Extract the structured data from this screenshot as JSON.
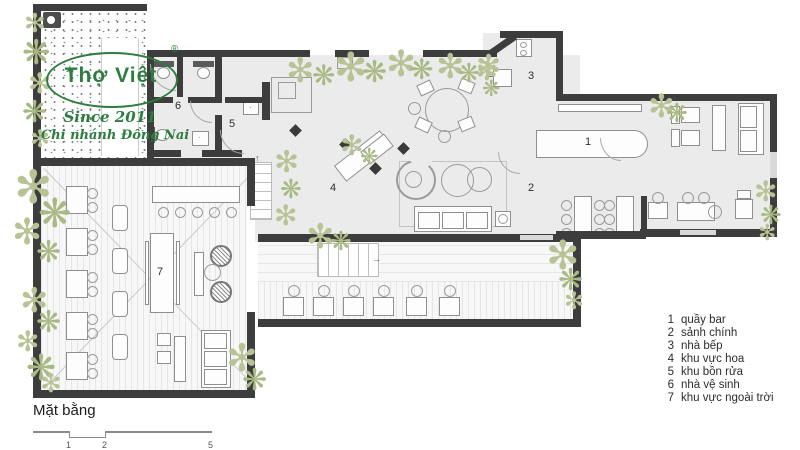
{
  "logo": {
    "brand": "Thợ Việt",
    "registered": "®",
    "since": "Since 2011",
    "branch": "Chi nhánh Đồng Nai"
  },
  "plan": {
    "title": "Mặt bằng",
    "room_numbers": {
      "bar": "1",
      "hall": "2",
      "kitchen": "3",
      "flower": "4",
      "wash": "5",
      "toilet": "6",
      "outdoor": "7"
    },
    "scale_ticks": [
      "1",
      "2",
      "5"
    ]
  },
  "legend": {
    "items": [
      {
        "num": "1",
        "label": "quầy bar"
      },
      {
        "num": "2",
        "label": "sảnh chính"
      },
      {
        "num": "3",
        "label": "nhà bếp"
      },
      {
        "num": "4",
        "label": "khu vực hoa"
      },
      {
        "num": "5",
        "label": "khu bồn rửa"
      },
      {
        "num": "6",
        "label": "nhà vệ sinh"
      },
      {
        "num": "7",
        "label": "khu vực ngoài trời"
      }
    ]
  },
  "icons": {
    "plant_glyph": "✻",
    "plant_glyph_alt": "❋",
    "stair_up_arrow": "↑",
    "stair_right_arrow": "→",
    "mascot_glyph": "✶"
  },
  "colors": {
    "wall": "#3d3d3d",
    "floor": "#ebebeb",
    "plant": "#b7c394",
    "plant2": "#a9b984",
    "logo_green": "#2c7d3f",
    "deck": "#f7f7f7"
  }
}
